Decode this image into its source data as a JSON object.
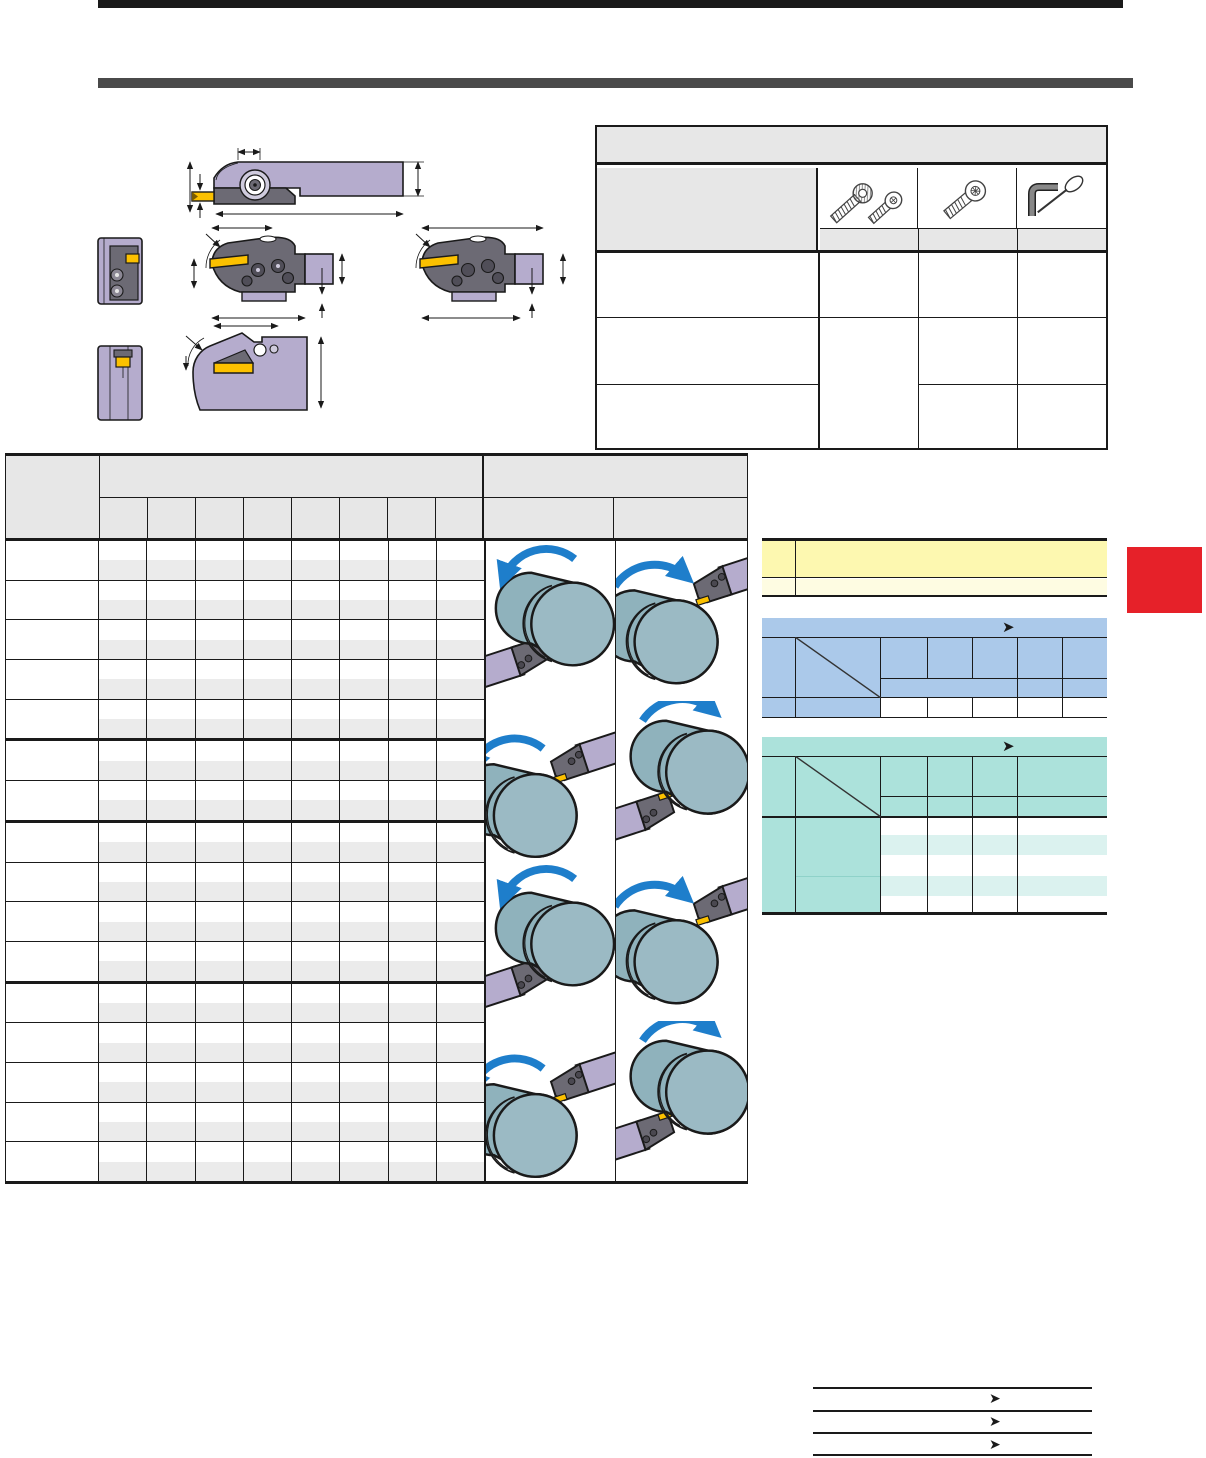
{
  "page": {
    "kind": "tool-catalog-page",
    "top_rule_color": "#1a1a1a",
    "section_bar_color": "#4a4a4a",
    "background": "#ffffff"
  },
  "glyphs": {
    "arrow_right": "➤"
  },
  "colors": {
    "line": "#1a1a1a",
    "table_header_fill": "#e7e7e7",
    "row_stripe": "#ebebeb",
    "tool_shank_lavender": "#b5accd",
    "tool_head_gray": "#6c6a74",
    "insert_yellow": "#fcc100",
    "workpiece_blue_gray": "#8fb2bc",
    "workpiece_face": "#9bbac4",
    "rotation_arrow_blue": "#1e7ecb",
    "note_yellow_dark": "#fdf8b0",
    "note_yellow_light": "#fefce2",
    "selection_blue": "#abc9ea",
    "selection_teal": "#ace2db",
    "teal_stripe": "#dbf2ef",
    "index_tab_red": "#e62129"
  },
  "diagrams": {
    "items": [
      {
        "name": "integral-holder-side-view"
      },
      {
        "name": "head-front-view-upper"
      },
      {
        "name": "modular-head-side-view-left"
      },
      {
        "name": "modular-head-side-view-right"
      },
      {
        "name": "head-front-view-lower"
      },
      {
        "name": "face-grooving-head-side-view"
      }
    ],
    "dimension_marks": 14
  },
  "spare_parts_table": {
    "tool_columns": [
      {
        "icon": "clamp-screws-icon"
      },
      {
        "icon": "torx-screw-icon"
      },
      {
        "icon": "hex-wrench-and-driver-icon"
      }
    ],
    "body_rows": 3
  },
  "main_table": {
    "data_columns": 8,
    "row_group_sections": [
      5,
      2,
      4,
      5
    ],
    "illustration_rows": [
      {
        "left": "od-turning-ccw-holder-lower-left",
        "right": "od-turning-cw-holder-upper-right"
      },
      {
        "left": "od-turning-ccw-holder-upper-right",
        "right": "od-turning-cw-holder-lower-left"
      },
      {
        "left": "od-turning-ccw-holder-lower-left",
        "right": "od-turning-cw-holder-upper-right"
      },
      {
        "left": "od-turning-ccw-holder-upper-right",
        "right": "od-turning-cw-holder-lower-left"
      }
    ]
  },
  "yellow_note_table": {
    "rows": 2
  },
  "blue_selection_table": {
    "arrow": "➤",
    "data_columns": 5,
    "data_rows": 1
  },
  "teal_selection_table": {
    "arrow": "➤",
    "data_columns": 4,
    "data_rows": 2
  },
  "footer_index": {
    "rule_count": 4,
    "arrow": "➤",
    "arrow_count": 3
  }
}
